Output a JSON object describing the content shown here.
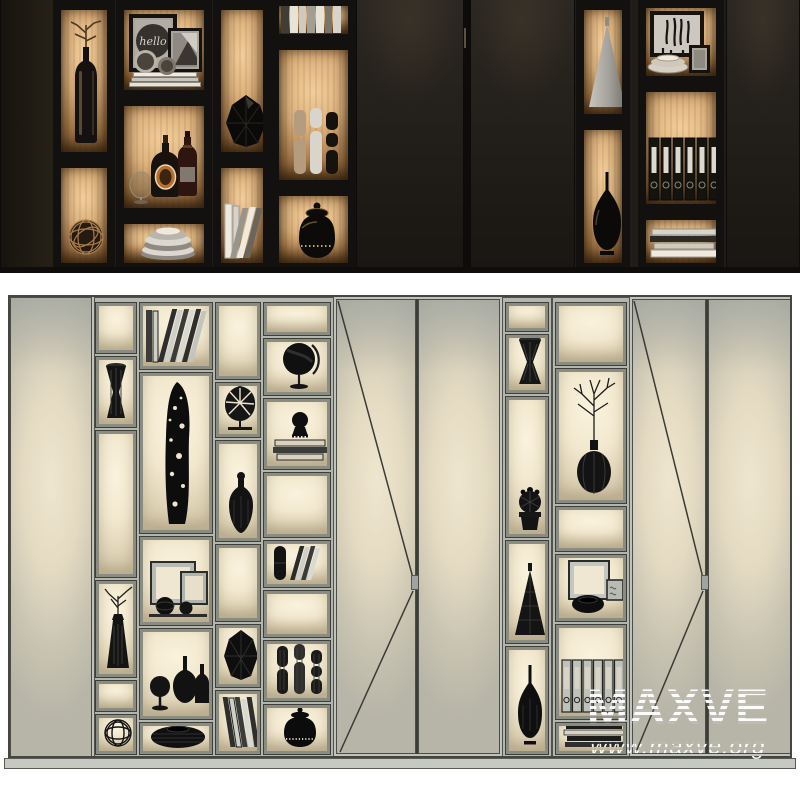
{
  "watermark": {
    "brand": "MAXVE",
    "url": "www.maxve.org"
  },
  "artwork": {
    "hello_print_text": "hello"
  },
  "colors": {
    "photo_background": "#201c17",
    "photo_frame_black": "#131110",
    "backlit_wood": "#d3a873",
    "clay_cabinet_gray": "#b3b6af",
    "clay_door": "#c6c2b3",
    "niche_cream": "#f2e8cf",
    "liqueur_label_orange": "#b96f2a",
    "watermark_white": "#ffffff"
  },
  "scenes": {
    "top_photo_objects": [
      "branch-in-bottle-vase",
      "woven-metal-sphere",
      "hello-print-frame",
      "abstract-print-frame",
      "round-ornaments",
      "white-books",
      "liqueur-bottle",
      "whiskey-bottle",
      "cognac-glass",
      "striped-plate-stack",
      "faceted-black-vase",
      "leaning-books",
      "book-row",
      "cylinder-vases",
      "black-ginger-jar",
      "metal-cone",
      "teardrop-black-vase",
      "zebra-print-frame",
      "ceramic-bowl-stack",
      "small-photo-frame",
      "black-binders",
      "book-stack"
    ],
    "bottom_clay_objects": [
      "hourglass-vase",
      "leaning-books",
      "perforated-sculpture",
      "monstera-leaf-decor",
      "desk-globe",
      "bust-on-books",
      "picture-frames-with-spheres",
      "bottles-and-glass",
      "ribbed-bowl",
      "branch-vase",
      "woven-sphere",
      "faceted-vase",
      "pill-vase-with-books",
      "cylinder-vases",
      "lidded-jar",
      "striped-hourglass-vase",
      "cactus-pot",
      "cone-vase",
      "teardrop-vase",
      "branch-in-round-vase",
      "frame-and-oval-bowl",
      "binders",
      "book-stack"
    ]
  }
}
